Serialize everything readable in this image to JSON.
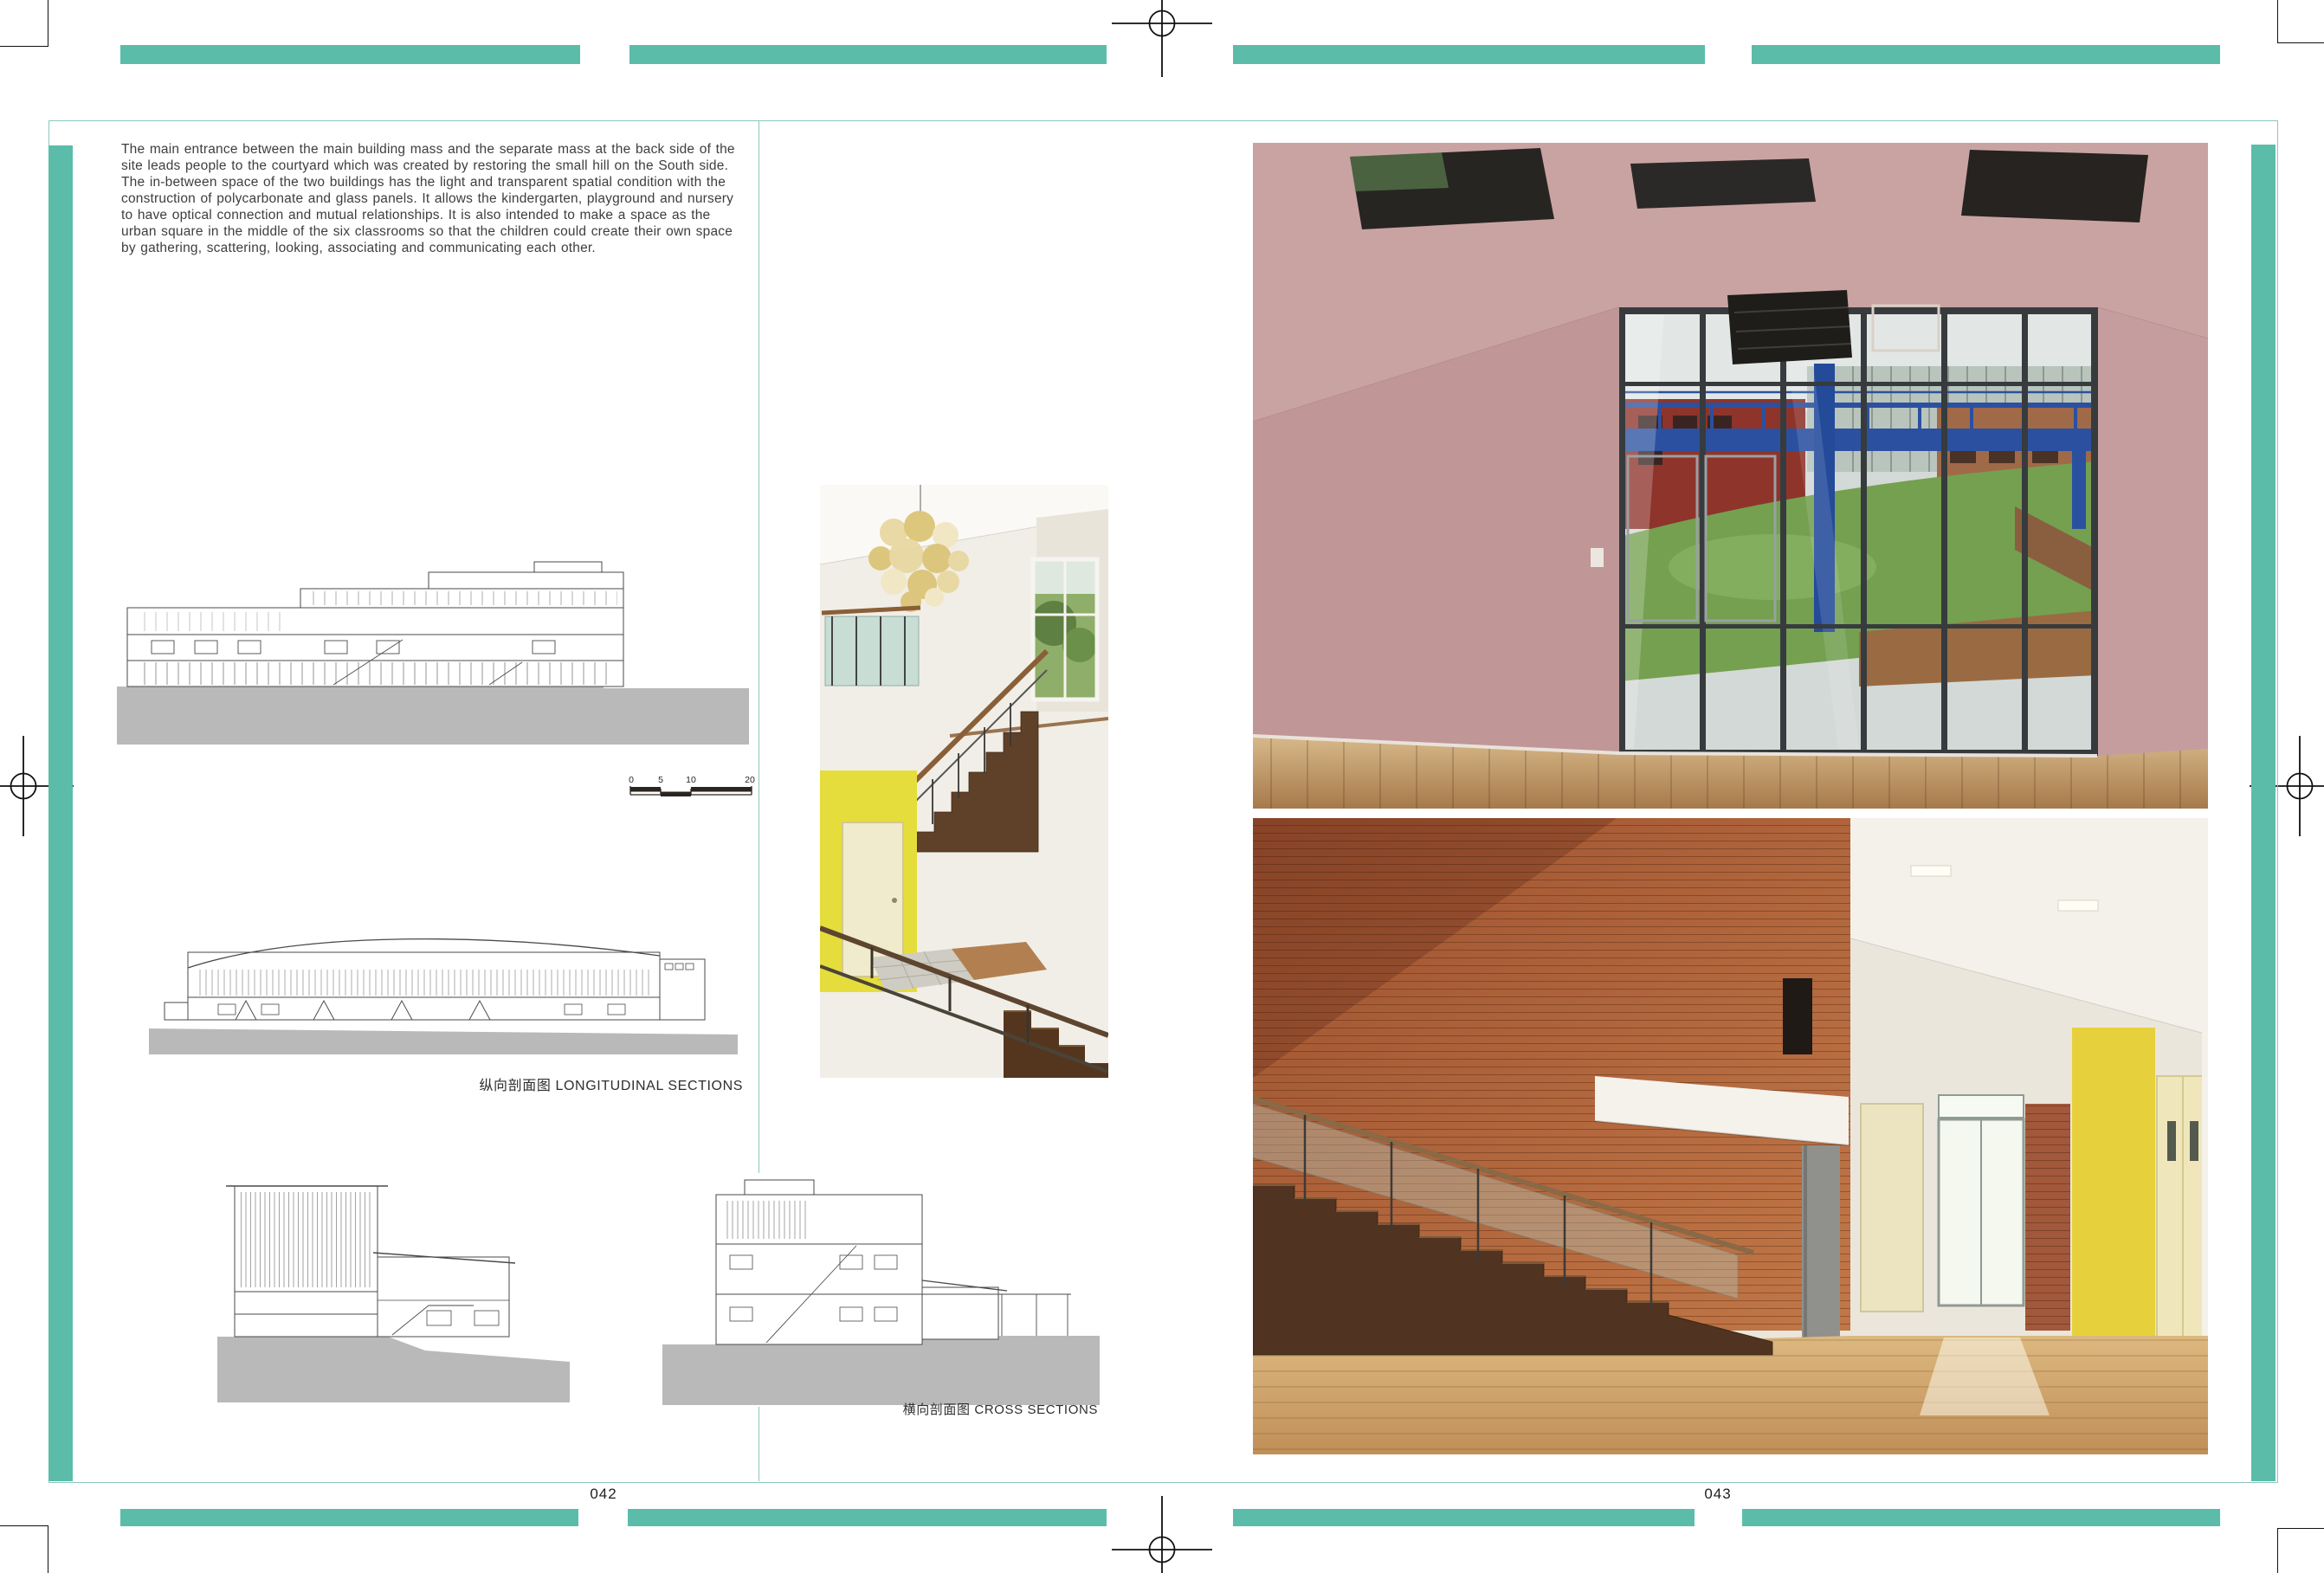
{
  "meta": {
    "left_page_number": "042",
    "right_page_number": "043"
  },
  "colors": {
    "accent_teal": "#5cbcaa",
    "frame_teal": "#8cc7bf",
    "ground_gray": "#b9b9b9"
  },
  "intro_paragraph": "The main entrance between the main building mass and the separate mass at the back side of the site leads people to the courtyard which was created by restoring the small hill on the South side. The in-between space of the two buildings has the light and transparent spatial condition with the construction of polycarbonate and glass panels. It allows the kindergarten, playground and nursery to have optical connection and mutual relationships. It is also intended to make a space as the urban square in the middle of the six classrooms so that the children could create their own space by gathering, scattering, looking, associating and communicating each other.",
  "section_labels": {
    "longitudinal": {
      "cn": "纵向剖面图",
      "en": "LONGITUDINAL SECTIONS"
    },
    "cross": {
      "cn": "横向剖面图",
      "en": "CROSS SECTIONS"
    }
  },
  "scale_bar": {
    "ticks": [
      "0",
      "5",
      "10",
      "20"
    ]
  }
}
